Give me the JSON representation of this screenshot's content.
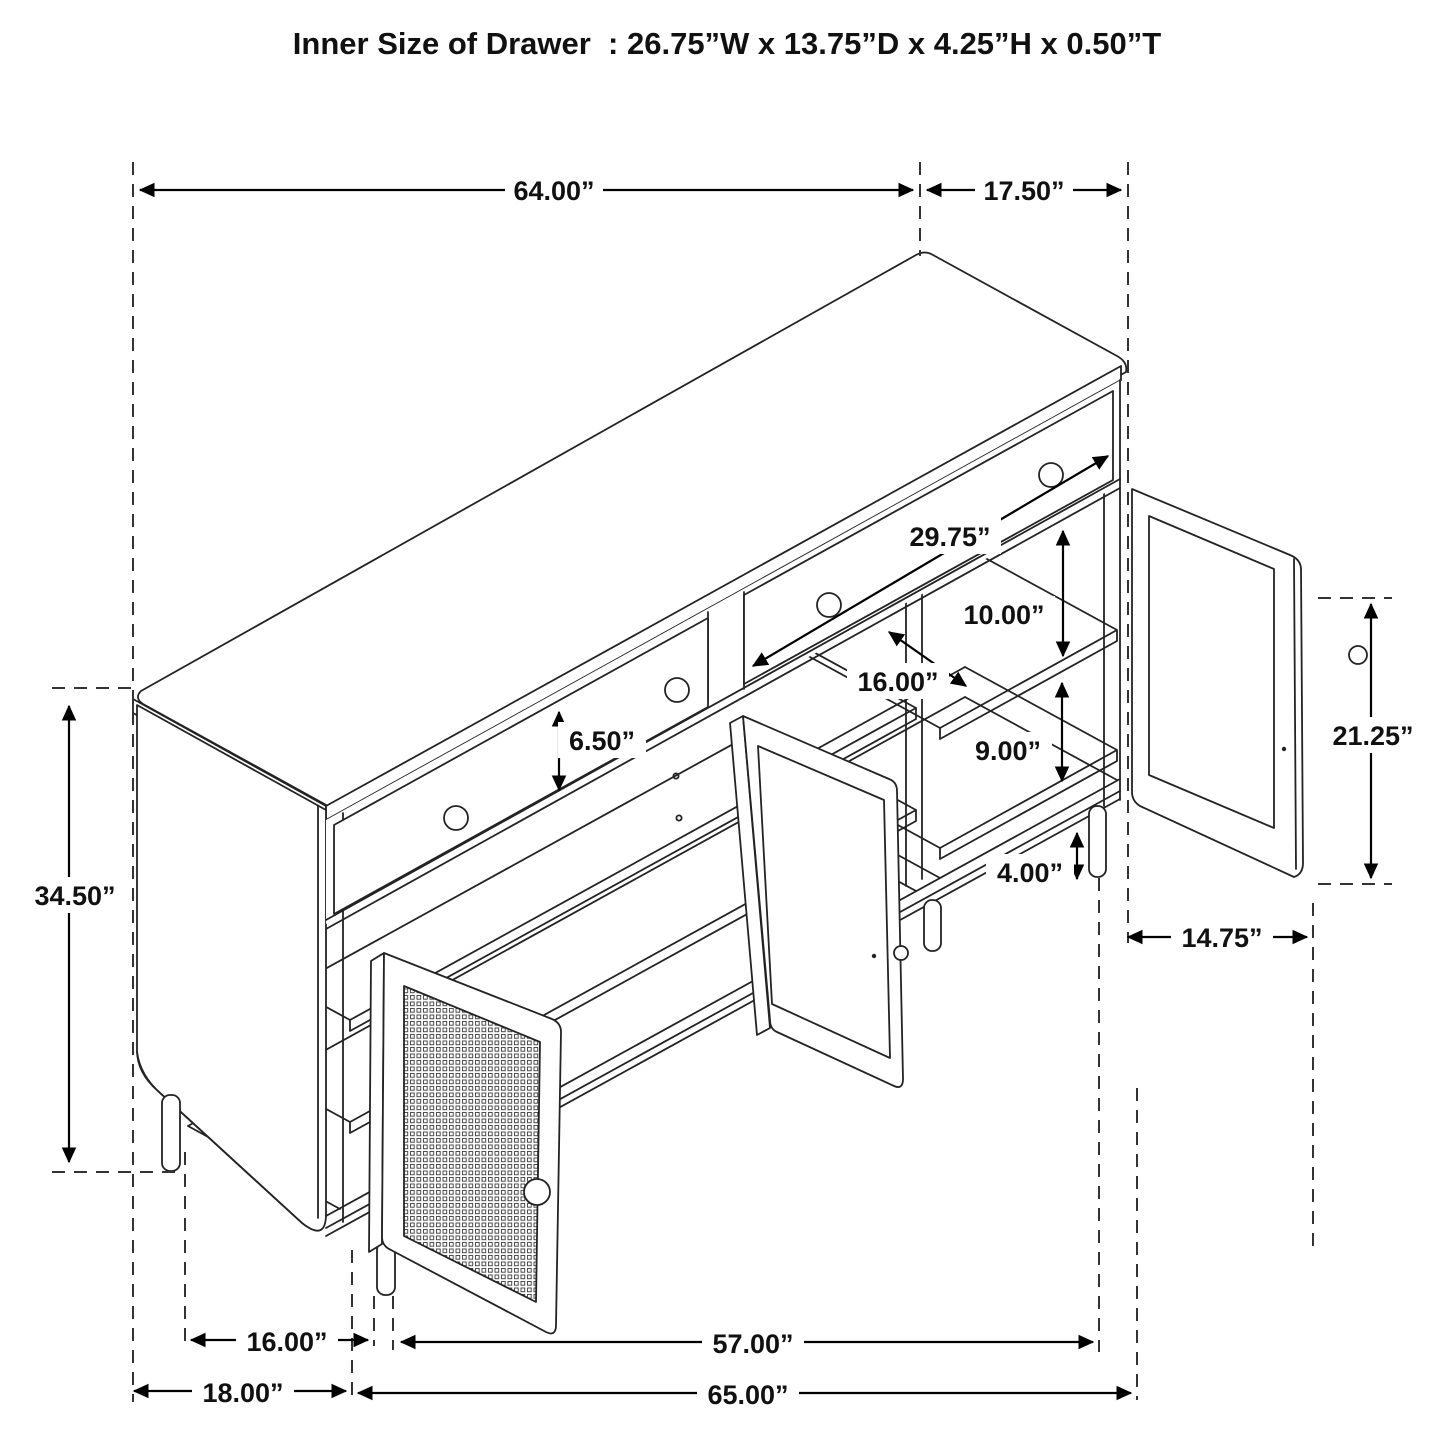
{
  "title": "Inner Size of Drawer  : 26.75”W x 13.75”D x 4.25”H x 0.50”T",
  "labels": {
    "top_width": "64.00”",
    "top_depth": "17.50”",
    "drawer_width": "29.75”",
    "upper_shelf_clearance": "10.00”",
    "shelf_depth": "16.00”",
    "lower_shelf_clearance": "9.00”",
    "leg_height": "4.00”",
    "drawer_face_height": "6.50”",
    "door_height": "21.25”",
    "door_width": "14.75”",
    "overall_height": "34.50”",
    "base_leg_depth": "16.00”",
    "front_leg_span": "57.00”",
    "base_depth": "18.00”",
    "overall_width": "65.00”"
  }
}
